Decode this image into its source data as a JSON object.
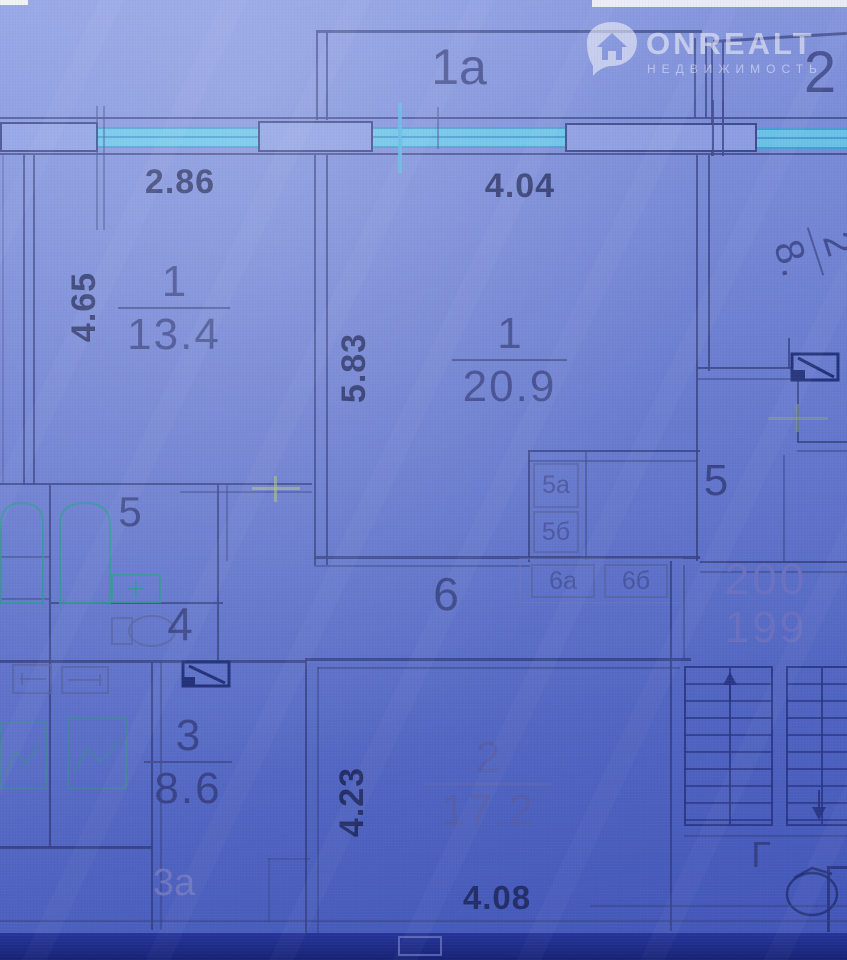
{
  "watermark": {
    "brand": "ONREALT",
    "subtitle": "НЕДВИЖИМОСТЬ"
  },
  "labels": {
    "balcony_1a": "1а",
    "balcony_2": "2",
    "loggia_3a": "3а",
    "hall": "6",
    "bath": "5",
    "wc": "4",
    "corridor": "5",
    "stair_letter": "Г",
    "closet_5a": "5а",
    "closet_5b": "5б",
    "closet_6a": "6а",
    "closet_6b": "6б",
    "apt_upper": "200",
    "apt_lower": "199"
  },
  "dimensions": {
    "top_left": "2.86",
    "top_center": "4.04",
    "left_v": "4.65",
    "center_v": "5.83",
    "room2_v": "4.23",
    "bottom": "4.08"
  },
  "rooms": {
    "living_left": {
      "num": "1",
      "area": "13.4"
    },
    "living_main": {
      "num": "1",
      "area": "20.9"
    },
    "kitchen": {
      "num": "3",
      "area": "8.6"
    },
    "bedroom": {
      "num": "2",
      "area": "17.2"
    },
    "clipped_right": {
      "num": "2",
      "area": "8."
    }
  },
  "colors": {
    "wall": "#33408c",
    "window": "#5ec3ec",
    "fixture": "#2f9e9e",
    "faded_label": "#757bd0",
    "background": "#6e82da"
  }
}
